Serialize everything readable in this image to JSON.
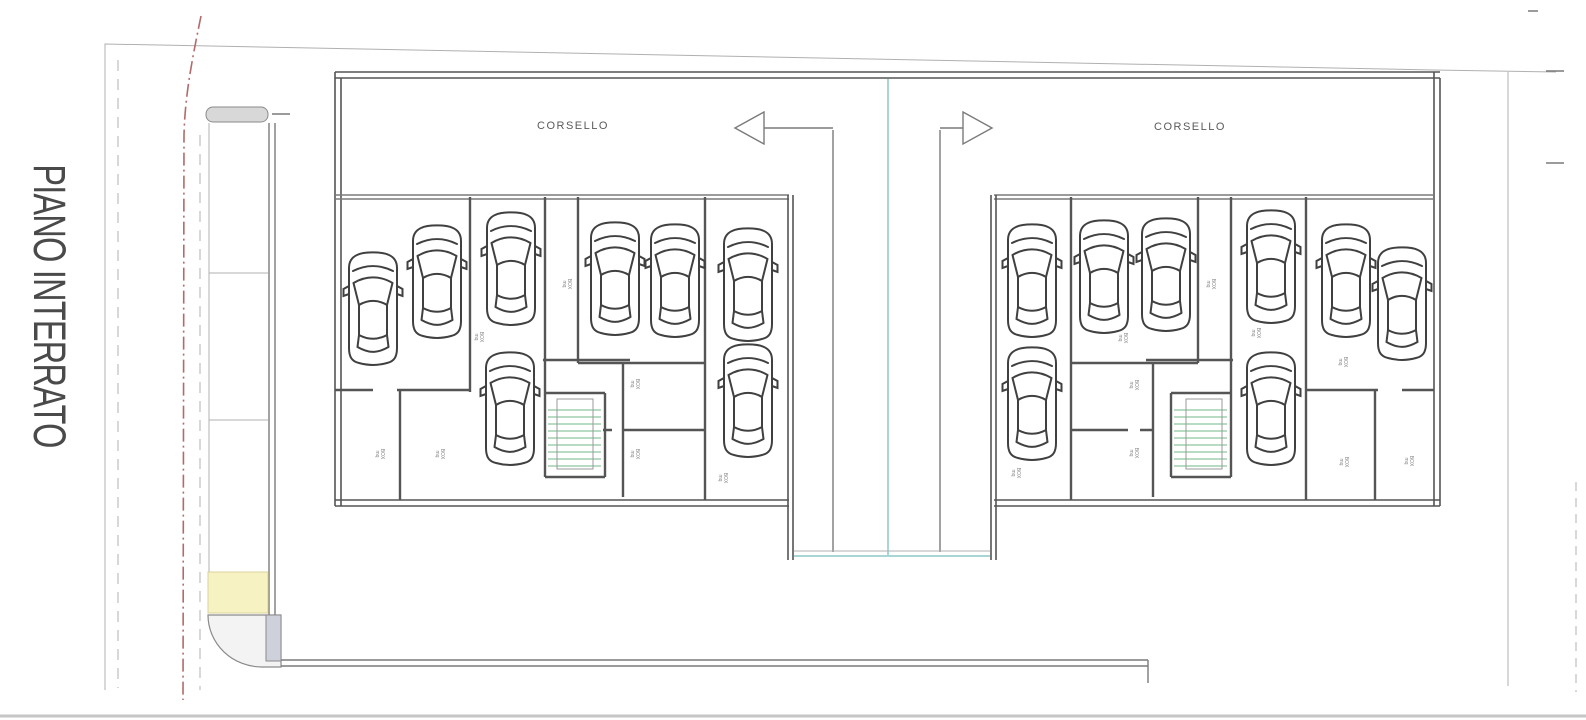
{
  "drawing": {
    "title": "PIANO INTERRATO",
    "aisle_label_left": "CORSELLO",
    "aisle_label_right": "CORSELLO"
  },
  "colors": {
    "wall": "#555555",
    "mid": "#7a7a7a",
    "light": "#b0b0b0",
    "teal": "#a7d6d4",
    "stair": "#aed6bc",
    "yellow": "#f6f2c2",
    "red": "#b26a6a",
    "grayfill": "#d8d8d8",
    "car": "#404040"
  },
  "cars": {
    "left_block": [
      {
        "cx": 373,
        "top": 250
      },
      {
        "cx": 437,
        "top": 223
      },
      {
        "cx": 511,
        "top": 210
      },
      {
        "cx": 615,
        "top": 220
      },
      {
        "cx": 675,
        "top": 222
      },
      {
        "cx": 748,
        "top": 226
      },
      {
        "cx": 510,
        "top": 350
      },
      {
        "cx": 748,
        "top": 342
      }
    ],
    "right_block": [
      {
        "cx": 1032,
        "top": 222
      },
      {
        "cx": 1104,
        "top": 218
      },
      {
        "cx": 1166,
        "top": 216
      },
      {
        "cx": 1271,
        "top": 208
      },
      {
        "cx": 1346,
        "top": 222
      },
      {
        "cx": 1402,
        "top": 245
      },
      {
        "cx": 1032,
        "top": 345
      },
      {
        "cx": 1271,
        "top": 350
      }
    ]
  },
  "parking_labels": {
    "line1": "BOX",
    "line2": "mq",
    "positions": [
      {
        "x": 478,
        "y": 337
      },
      {
        "x": 566,
        "y": 284
      },
      {
        "x": 634,
        "y": 384
      },
      {
        "x": 634,
        "y": 454
      },
      {
        "x": 379,
        "y": 454
      },
      {
        "x": 439,
        "y": 454
      },
      {
        "x": 722,
        "y": 478
      },
      {
        "x": 1122,
        "y": 338
      },
      {
        "x": 1210,
        "y": 284
      },
      {
        "x": 1255,
        "y": 333
      },
      {
        "x": 1342,
        "y": 362
      },
      {
        "x": 1133,
        "y": 385
      },
      {
        "x": 1133,
        "y": 453
      },
      {
        "x": 1343,
        "y": 462
      },
      {
        "x": 1408,
        "y": 461
      },
      {
        "x": 1015,
        "y": 473
      }
    ]
  }
}
